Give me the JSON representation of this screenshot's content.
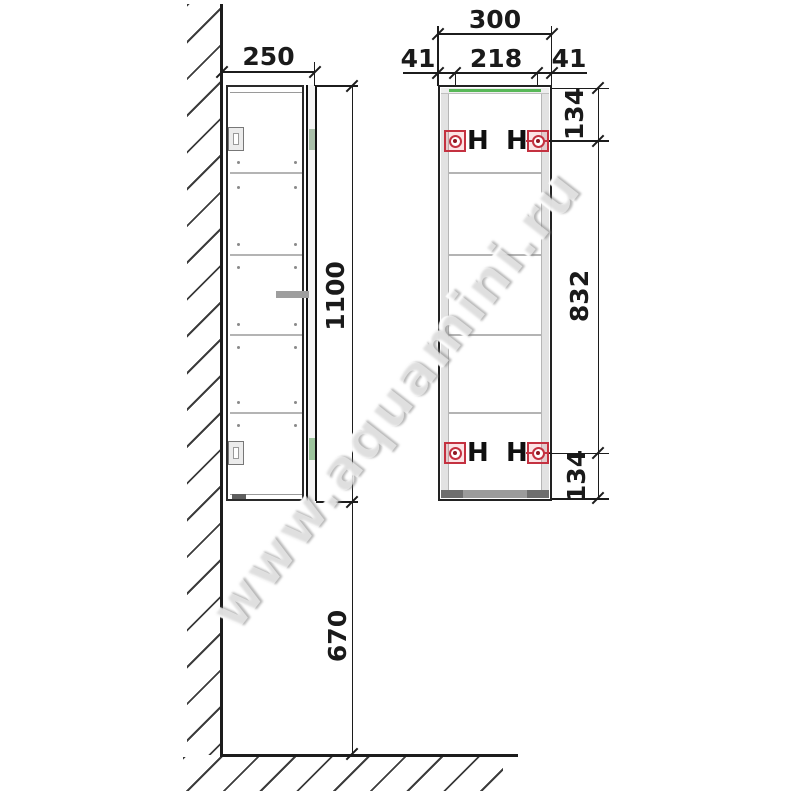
{
  "drawing": {
    "title": "wall-cabinet-installation-dimension-diagram",
    "watermark": "www.aquamini.ru",
    "side_view": {
      "width": "250",
      "height": "1100",
      "height_from_floor": "670"
    },
    "front_view": {
      "total_width": "300",
      "left_margin": "41",
      "hanger_spacing": "218",
      "right_margin": "41",
      "top_margin": "134",
      "hanger_vertical_spacing": "832",
      "bottom_margin": "134",
      "hanger_label": "H"
    },
    "colors": {
      "outline": "#1c1c1c",
      "hanger_red": "#c43140",
      "accent_green": "#58b858",
      "shelf_gray": "#b4b4b4"
    }
  }
}
